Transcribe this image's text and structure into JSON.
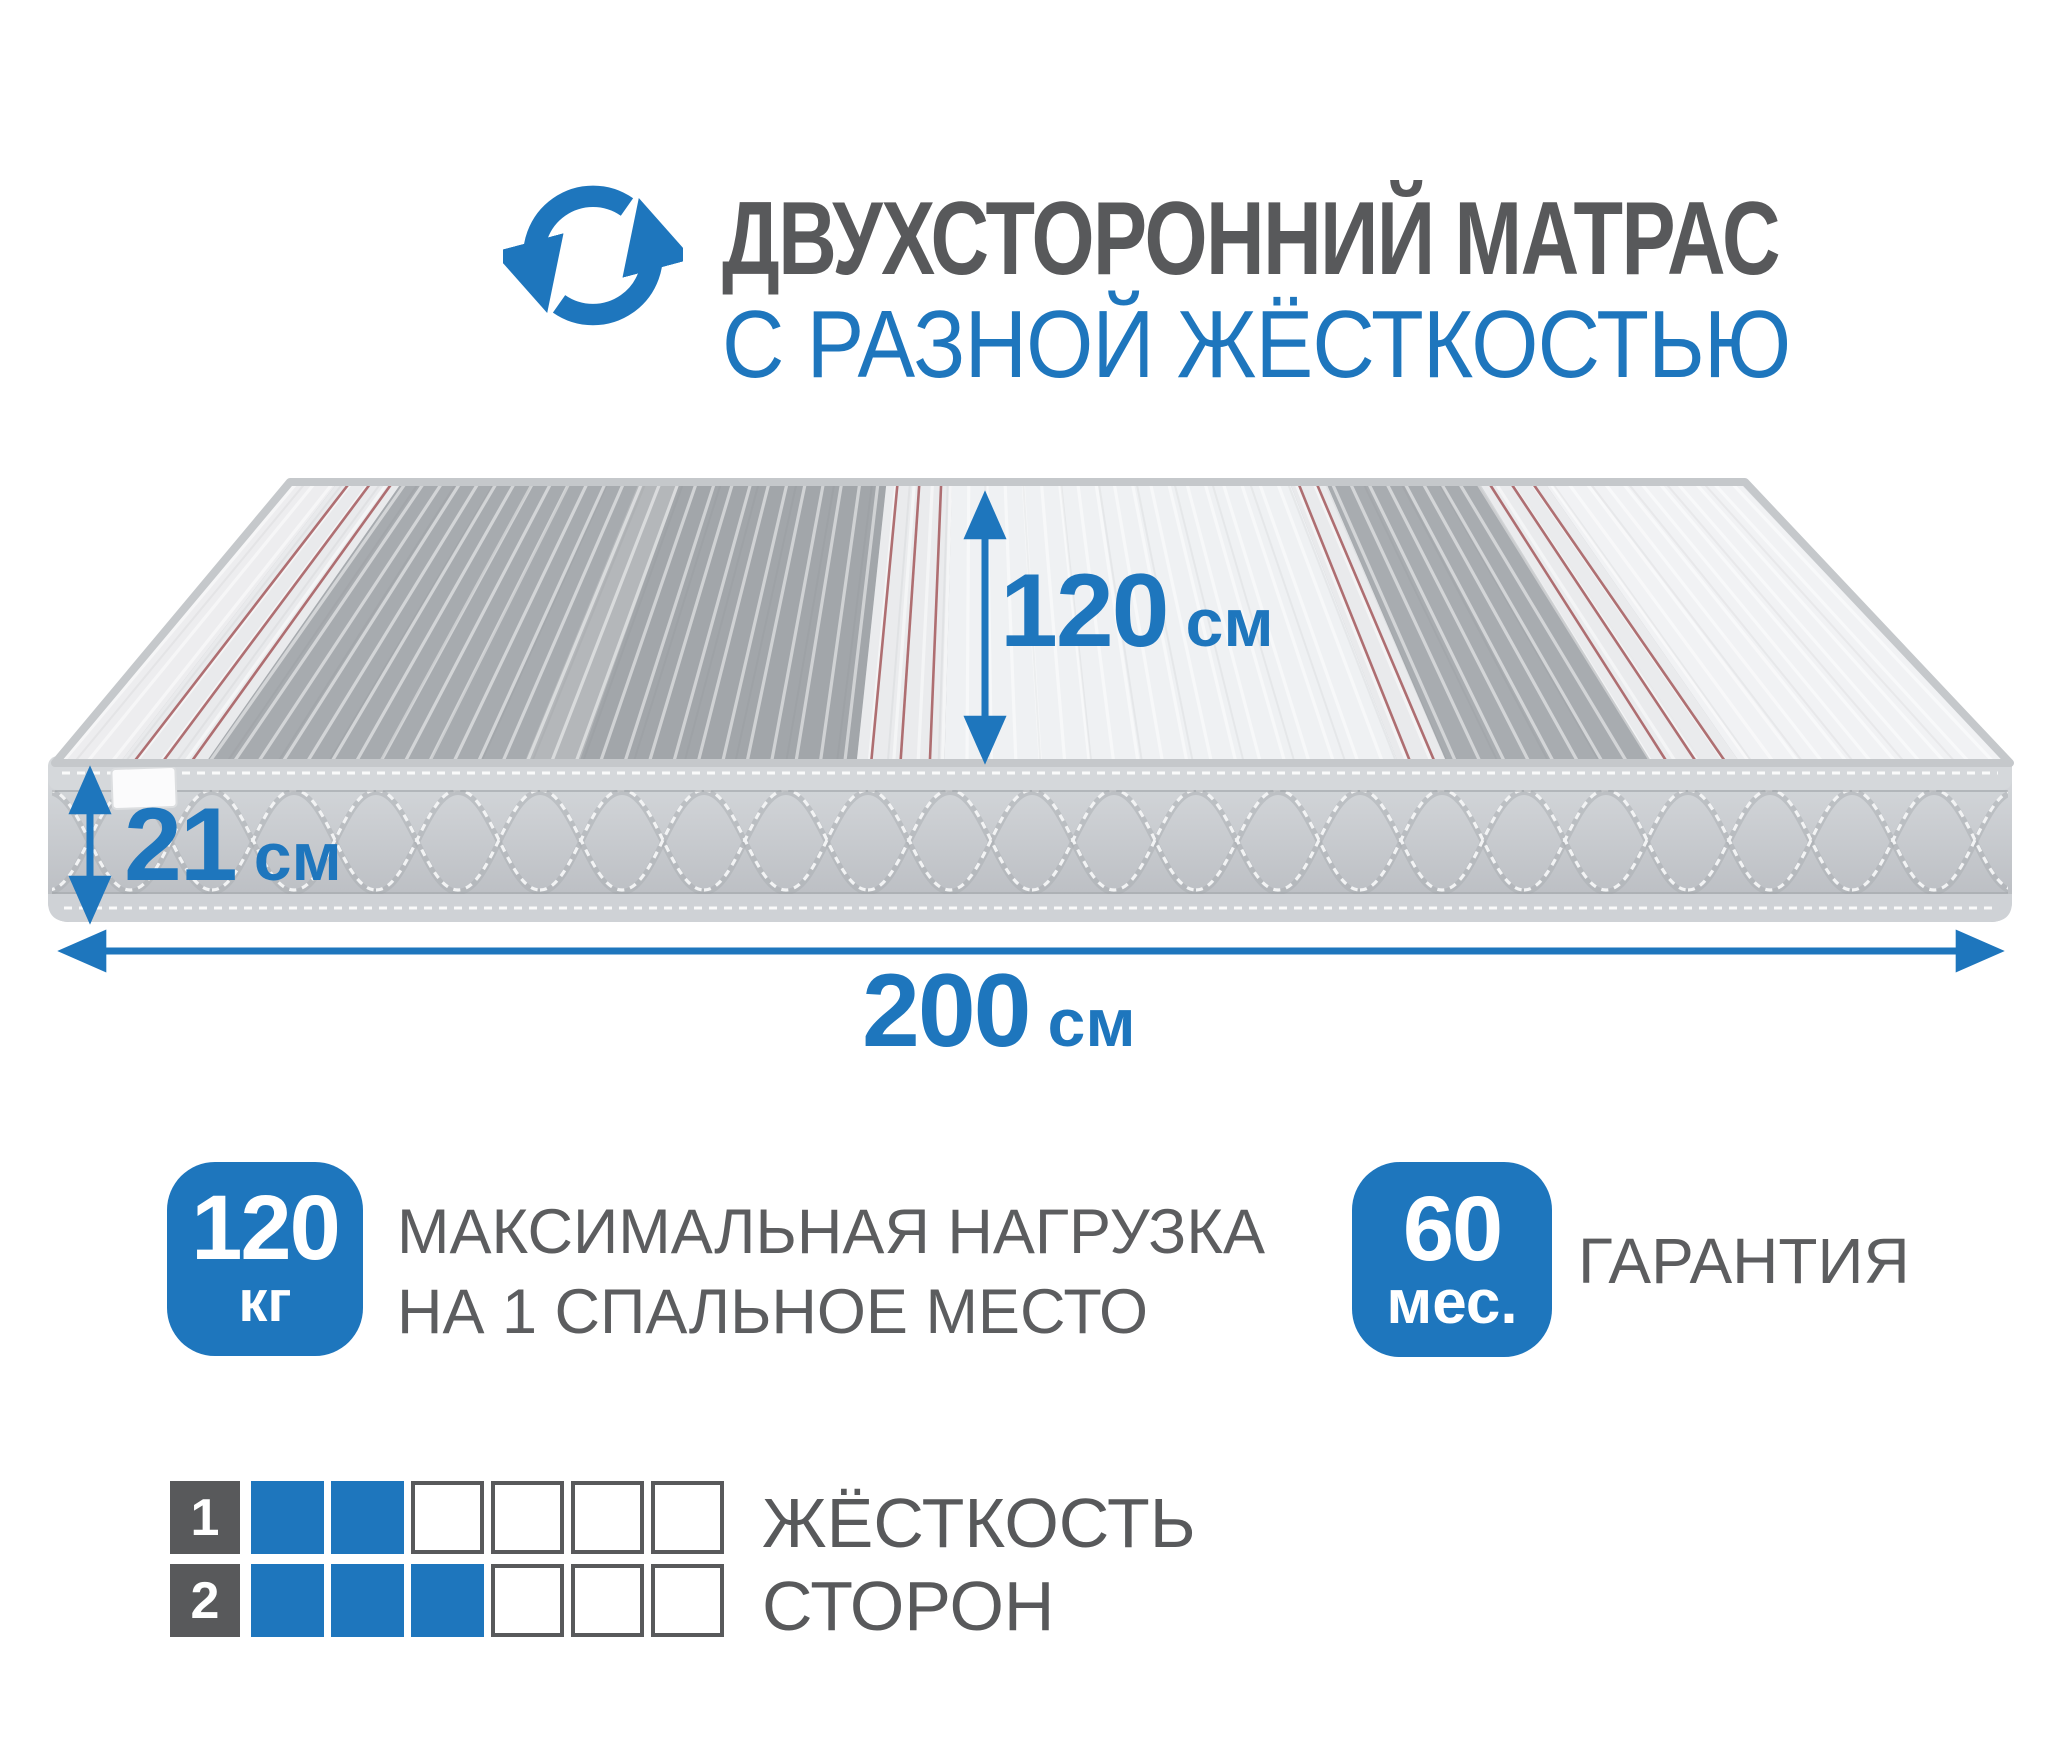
{
  "header": {
    "title": "ДВУХСТОРОННИЙ МАТРАС",
    "subtitle": "С РАЗНОЙ ЖЁСТКОСТЬЮ"
  },
  "dimensions": {
    "width": {
      "value": "120",
      "unit": "см"
    },
    "height": {
      "value": "21",
      "unit": "см"
    },
    "length": {
      "value": "200",
      "unit": "см"
    }
  },
  "badges": {
    "load": {
      "value": "120",
      "unit": "кг",
      "label_line1": "МАКСИМАЛЬНАЯ НАГРУЗКА",
      "label_line2": "НА 1 СПАЛЬНОЕ МЕСТО"
    },
    "warranty": {
      "value": "60",
      "unit": "мес.",
      "label": "ГАРАНТИЯ"
    }
  },
  "firmness": {
    "label_line1": "ЖЁСТКОСТЬ",
    "label_line2": "СТОРОН",
    "scale_max": 6,
    "rows": [
      {
        "index": "1",
        "filled": 2
      },
      {
        "index": "2",
        "filled": 3
      }
    ]
  },
  "icons": {
    "rotate": "rotate-icon"
  },
  "colors": {
    "accent": "#1e76bd",
    "text_gray": "#58595b",
    "body_text_gray": "#5c5d5f"
  }
}
